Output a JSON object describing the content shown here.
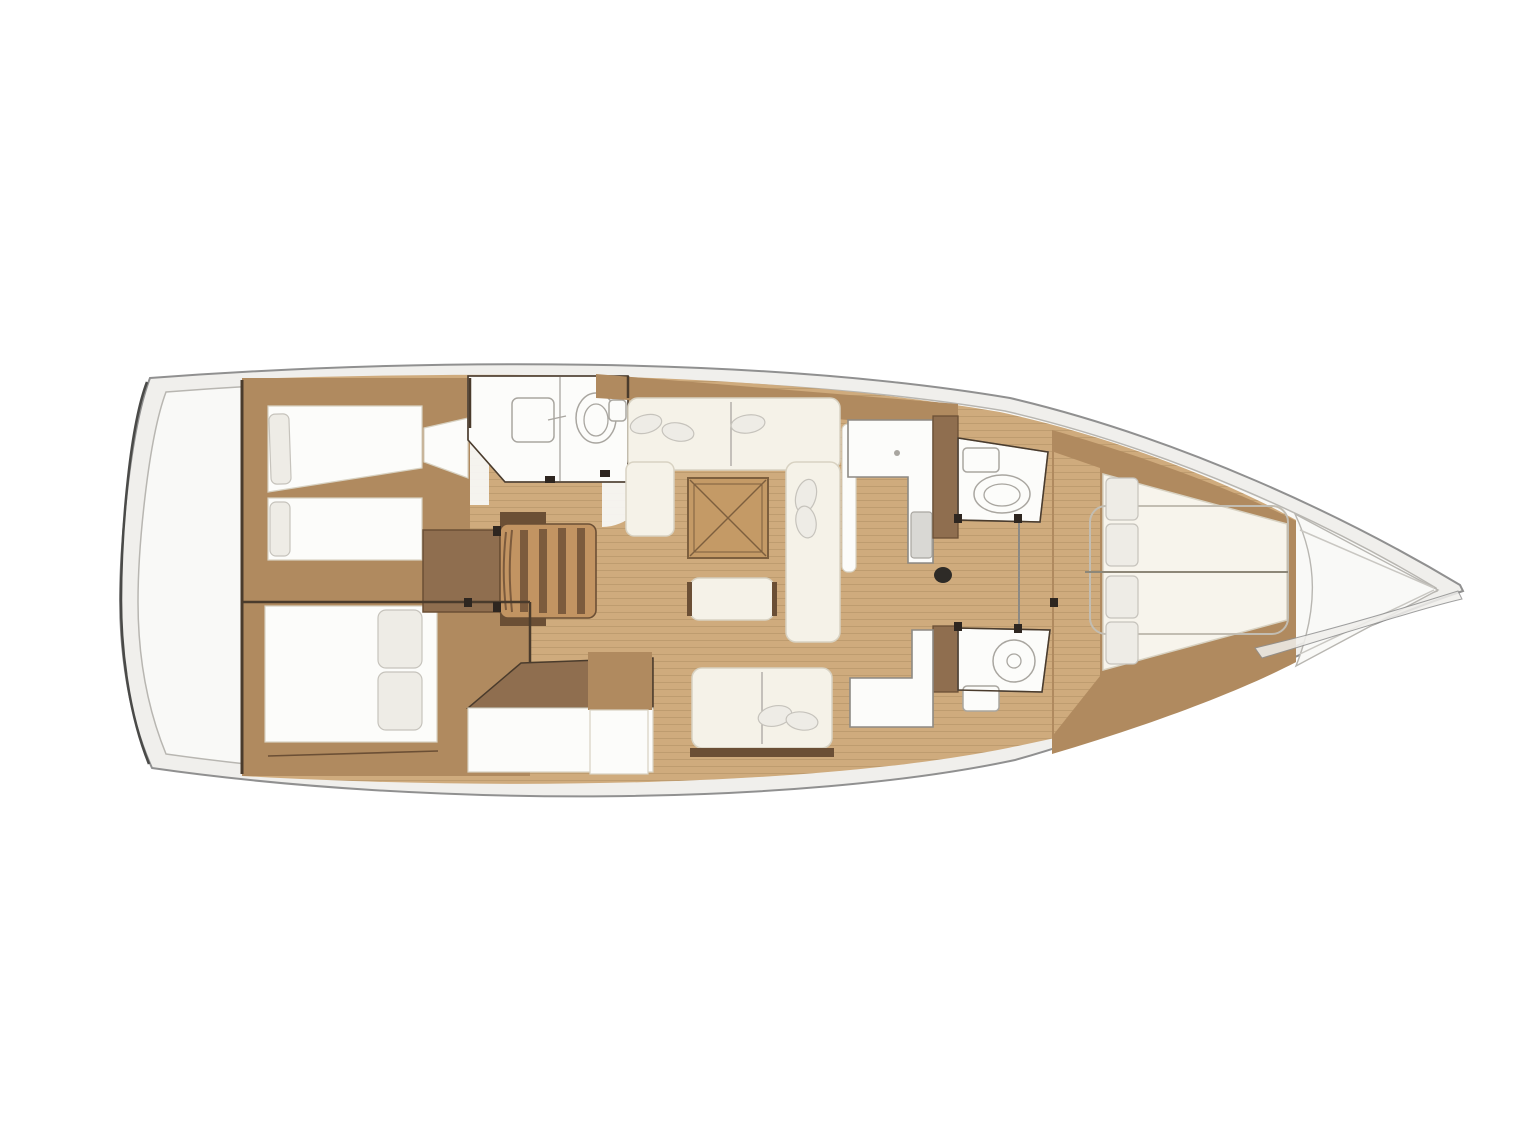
{
  "diagram": {
    "type": "yacht-interior-floor-plan",
    "orientation": "bow-right",
    "description": "Top-down interior layout plan of a sailing yacht hull with cabins, heads, galley and salon"
  },
  "features": [
    "aft-cabin-port-twin-berths",
    "aft-cabin-starboard-double-berth",
    "companionway-steps",
    "aft-head-with-shower",
    "salon-u-sofa",
    "salon-folding-table",
    "salon-ottoman",
    "starboard-settee",
    "galley-counter-with-sink",
    "nav-counter",
    "forward-head-port",
    "forward-head-starboard",
    "forward-owner-cabin-v-berth",
    "mast-post",
    "forepeak-locker"
  ],
  "colors": {
    "background": "#ffffff",
    "deck": "#f0efec",
    "hull_stroke": "#909090",
    "stern_accent": "#4a4a48",
    "hull_inner": "#f9f9f7",
    "inner_stroke": "#b8b6b1",
    "floor": "#cfab7d",
    "plank": "rgba(96,66,34,0.15)",
    "furniture": "#b08a5f",
    "furniture_dark": "#8f6e4f",
    "wood_dark": "#6b4f35",
    "wall": "#4a3b2c",
    "white_room": "#fcfcfa",
    "room_stroke": "#8d8a84",
    "cushion": "#f5f2e8",
    "cushion_stroke": "#d8d2c2",
    "pillow": "#eeece6",
    "pillow_stroke": "#c6c3bc",
    "table_wood": "#c49a66",
    "table_stroke": "#7d5f3e",
    "steps_wood": "#c29462",
    "steps_bar": "#7c5b3d",
    "sink": "#d9d8d4",
    "fixture_stroke": "#a9a6a0",
    "mast": "#2e2b27",
    "hardware": "#2e2620",
    "forepeak_line": "#c9c7c2",
    "duvet_line": "#c2bdb2",
    "berth_center": "#8d8778"
  }
}
